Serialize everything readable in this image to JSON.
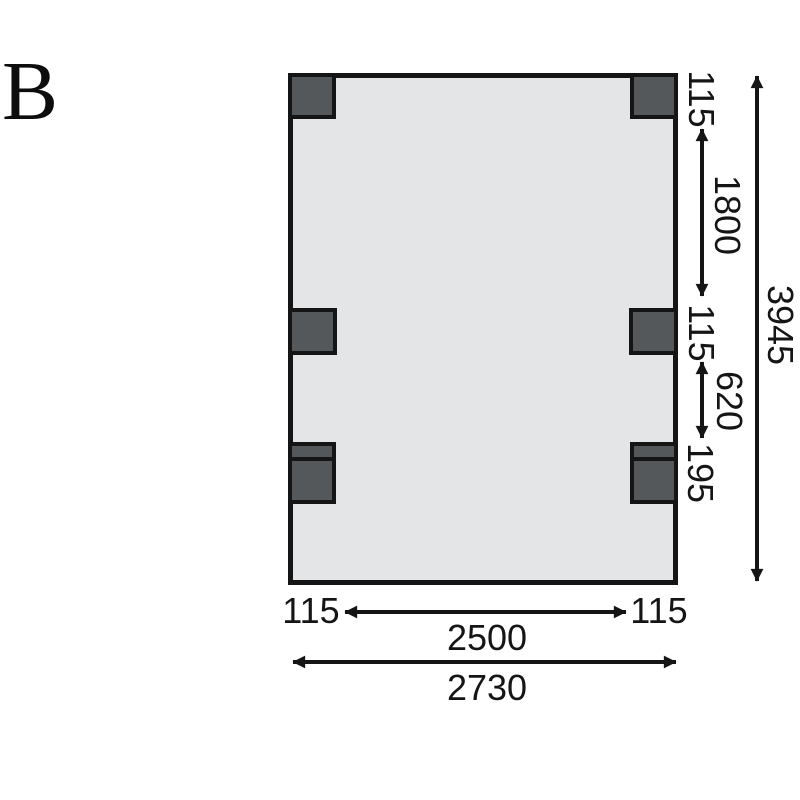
{
  "variant": "B",
  "plan": {
    "kind": "foundation-ground-plan",
    "posts": {
      "single_count": 4,
      "double_count": 2
    }
  },
  "dims": {
    "post_top": "115",
    "bay_top": "1800",
    "post_mid": "115",
    "bay_mid": "620",
    "post_double": "195",
    "depth_total": "3945",
    "edge_left": "115",
    "span_center": "2500",
    "edge_right": "115",
    "width_total": "2730"
  },
  "colors": {
    "line": "#151515",
    "floor_fill": "#e4e5e6",
    "post_fill": "#54585b"
  }
}
